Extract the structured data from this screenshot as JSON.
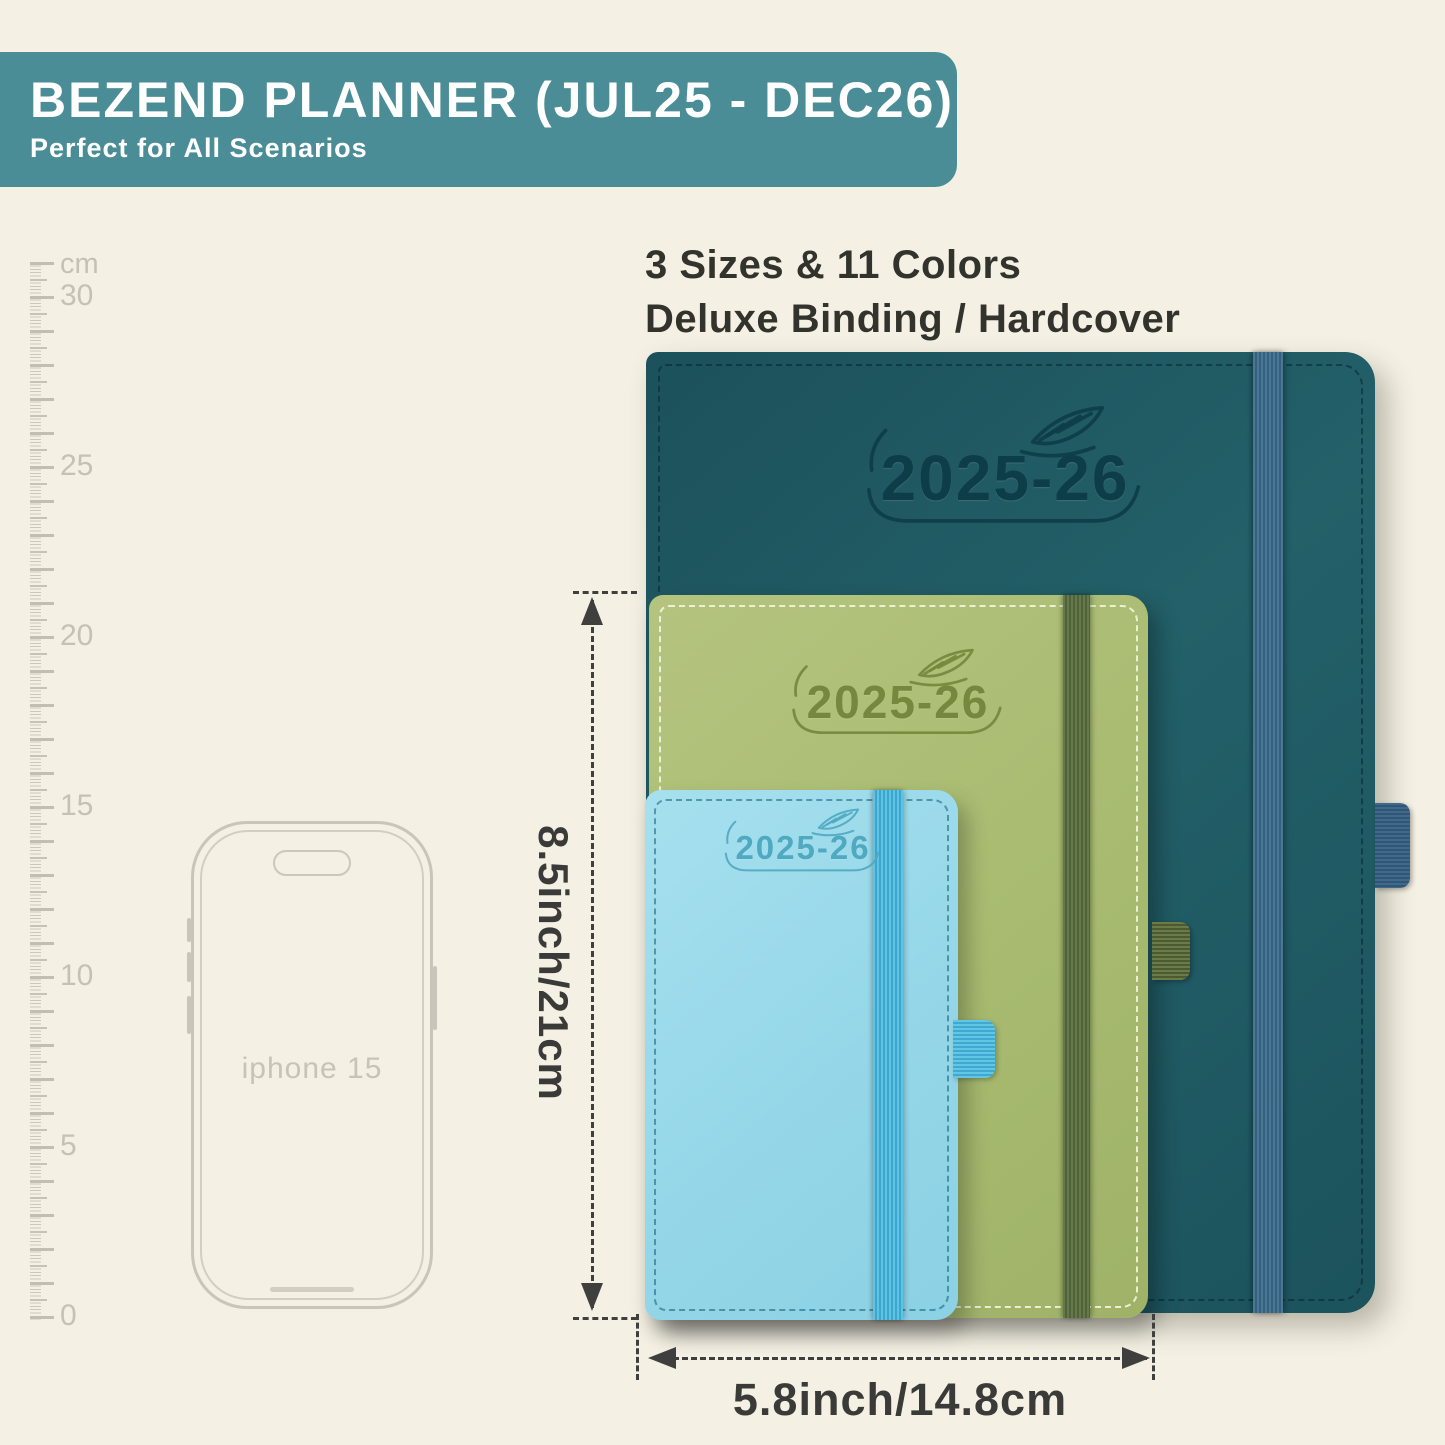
{
  "banner": {
    "title": "BEZEND PLANNER (JUL25 - DEC26)",
    "subtitle": "Perfect for All Scenarios",
    "bg_color": "#4a8d96"
  },
  "info": {
    "line1": "3 Sizes & 11 Colors",
    "line2": "Deluxe Binding / Hardcover"
  },
  "ruler": {
    "unit_label": "cm",
    "labels": [
      "30",
      "25",
      "20",
      "15",
      "10",
      "5",
      "0"
    ]
  },
  "phone": {
    "label": "iphone 15"
  },
  "planners": [
    {
      "name": "large-teal",
      "year_label": "2025-26",
      "cover_color": "#1e5661",
      "band_color": "#43718d"
    },
    {
      "name": "medium-green",
      "year_label": "2025-26",
      "cover_color": "#a9bc72",
      "band_color": "#5d7144"
    },
    {
      "name": "small-blue",
      "year_label": "2025-26",
      "cover_color": "#96d8e9",
      "band_color": "#4fb8dc"
    }
  ],
  "dimensions": {
    "height_label": "8.5inch/21cm",
    "width_label": "5.8inch/14.8cm"
  },
  "colors": {
    "background": "#f4f0e4",
    "annotation": "#3f3f3d",
    "ruler_gray": "#c5c1b6"
  }
}
